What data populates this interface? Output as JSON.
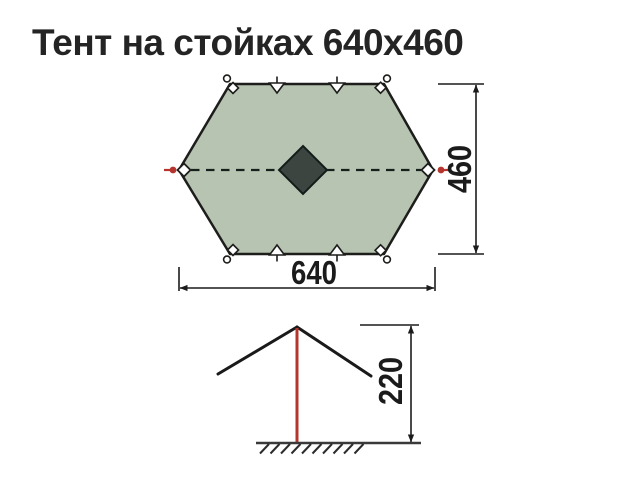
{
  "title": "Тент на стойках 640x460",
  "dimensions": {
    "width": "640",
    "depth": "460",
    "height": "220"
  },
  "colors": {
    "background": "#ffffff",
    "canopy_fill": "#b7c4b1",
    "outline": "#1d1d1b",
    "vent_fill": "#3d4541",
    "accent_red": "#b5352e",
    "dimension_line": "#1c1c1c",
    "title_text": "#242424"
  }
}
